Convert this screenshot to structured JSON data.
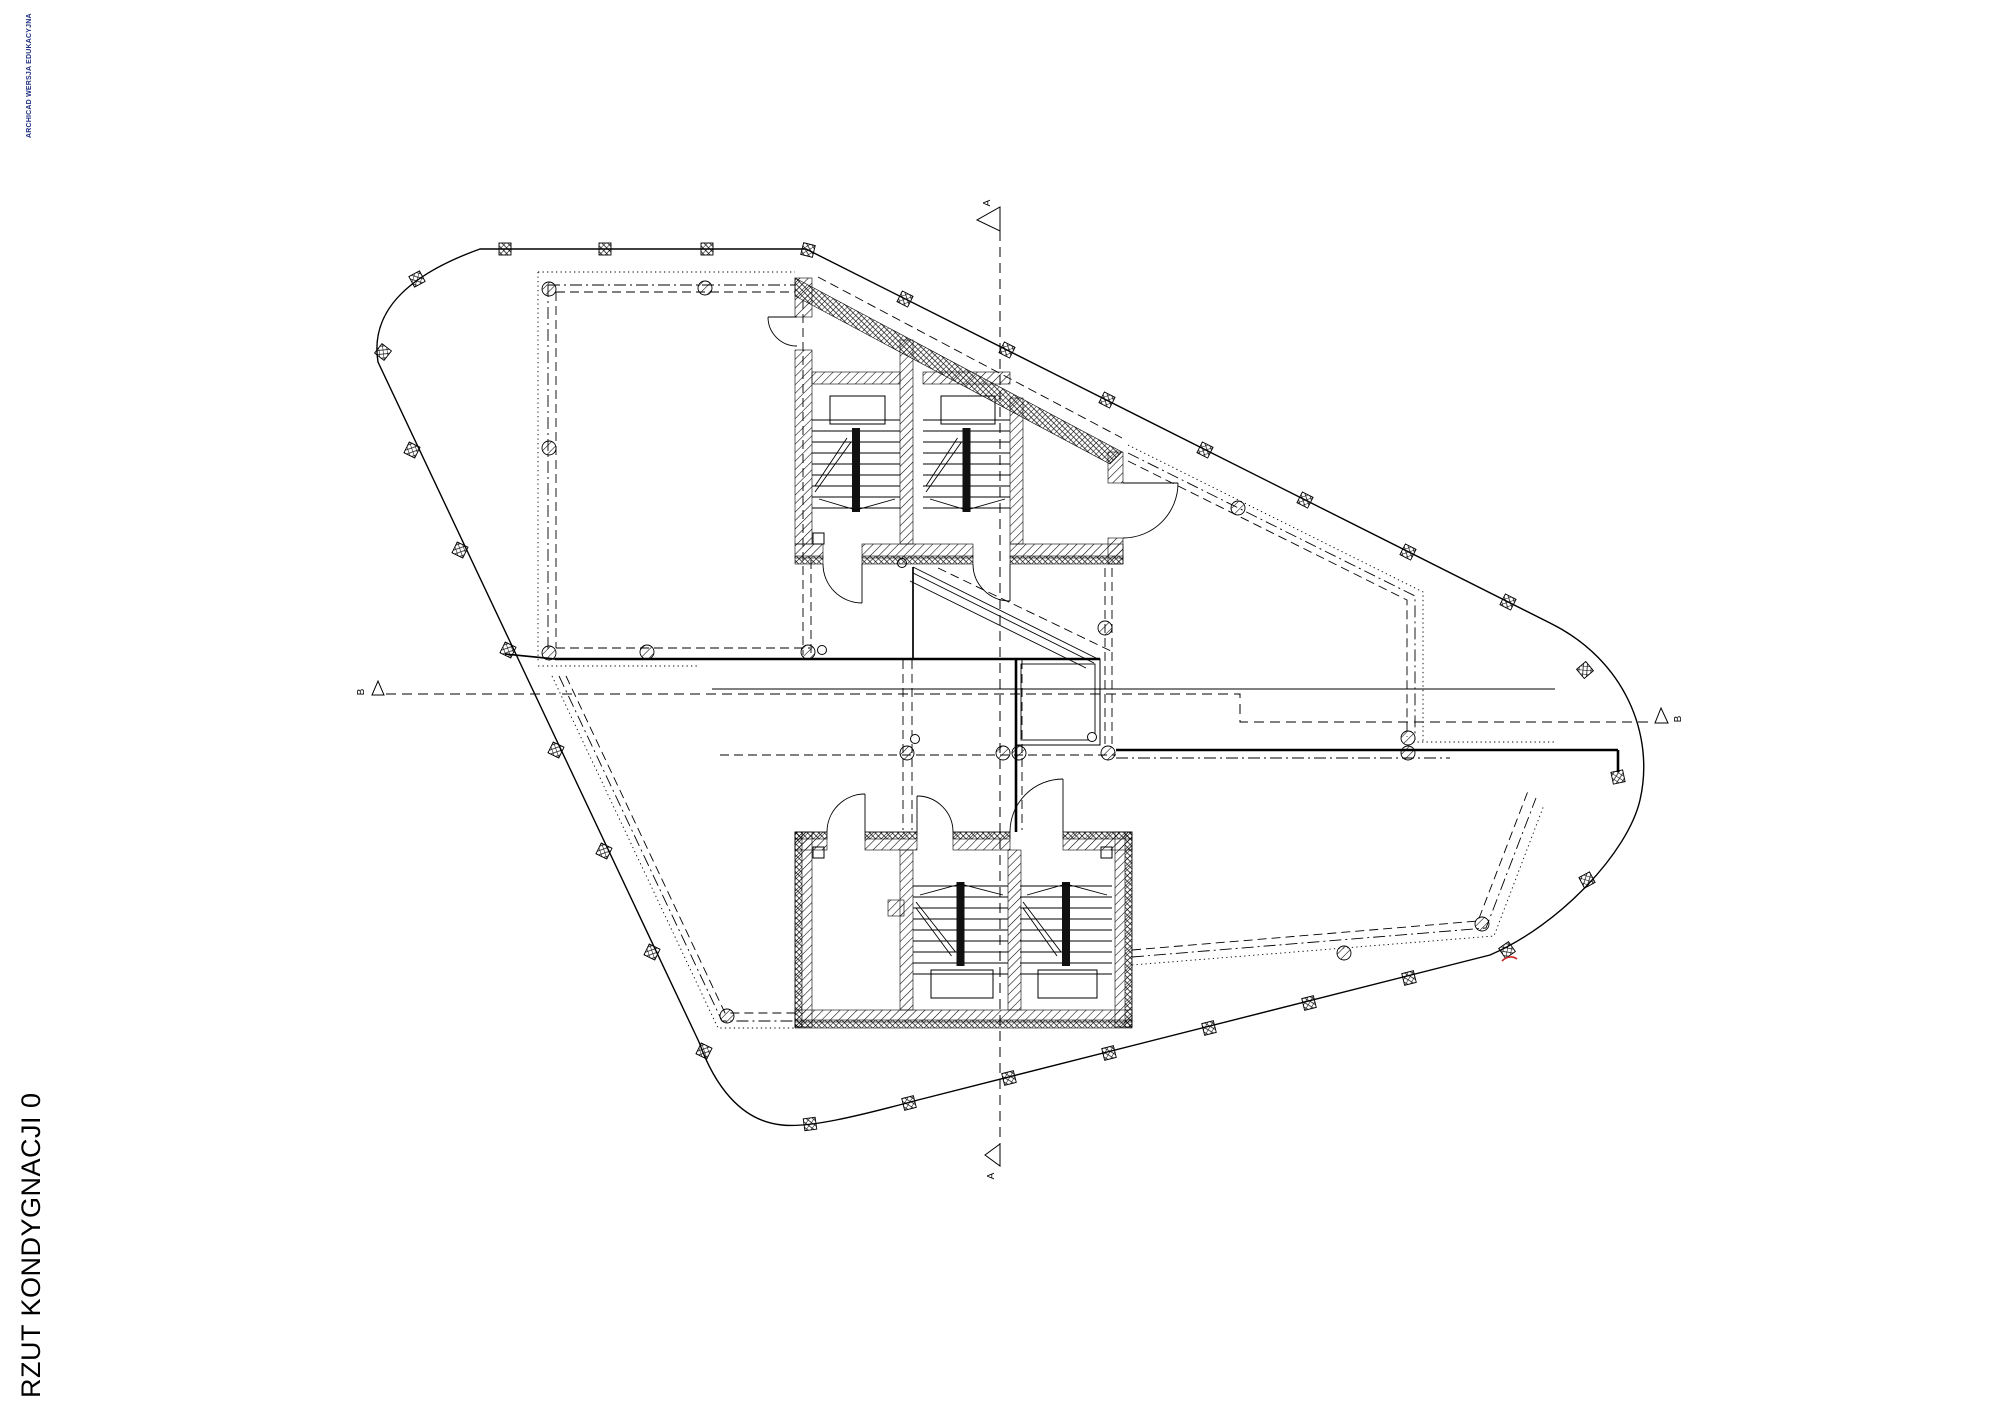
{
  "watermark": {
    "text": "ARCHICAD WERSJA EDUKACYJNA",
    "color": "#1f2f80"
  },
  "drawing_title": {
    "text": "RZUT KONDYGNACJI 0",
    "color": "#000000"
  },
  "section_marks": {
    "a_top": {
      "label": "A"
    },
    "a_bottom": {
      "label": "A"
    },
    "b_left": {
      "label": "B"
    },
    "b_right": {
      "label": "B"
    }
  },
  "colors": {
    "ink": "#000000",
    "paper": "#ffffff",
    "revision_mark": "#cc2222"
  }
}
